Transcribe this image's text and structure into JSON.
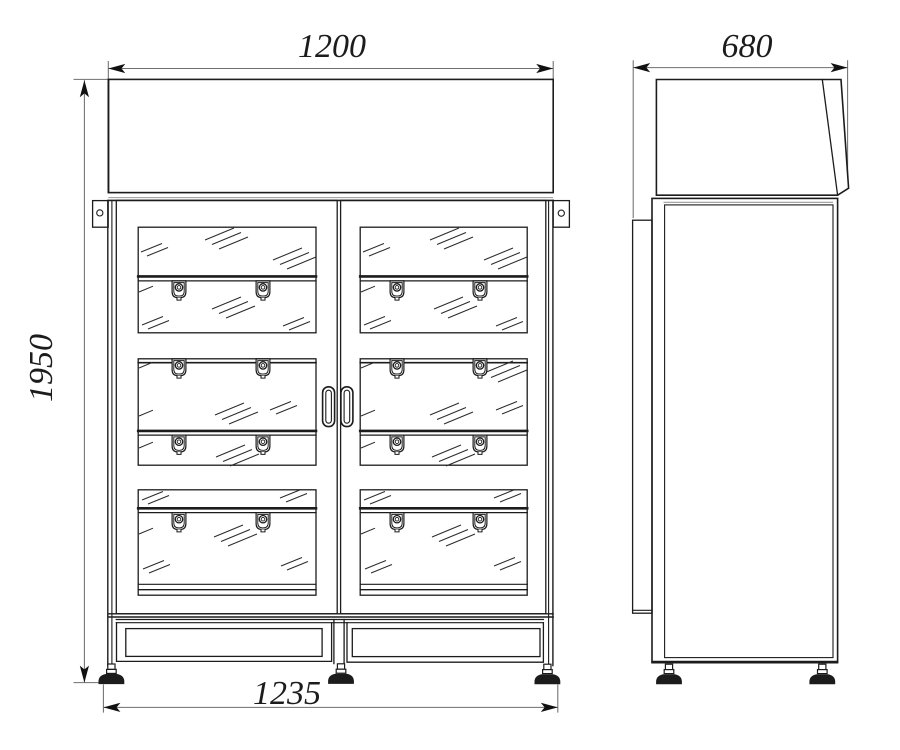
{
  "drawing": {
    "kind": "technical-drawing",
    "dimensions": {
      "front_width": "1200",
      "side_depth": "680",
      "front_height": "1950",
      "base_width": "1235"
    }
  },
  "colors": {
    "line": "#1c1c1c",
    "dim_line": "#6f6f6f",
    "background": "#ffffff"
  }
}
